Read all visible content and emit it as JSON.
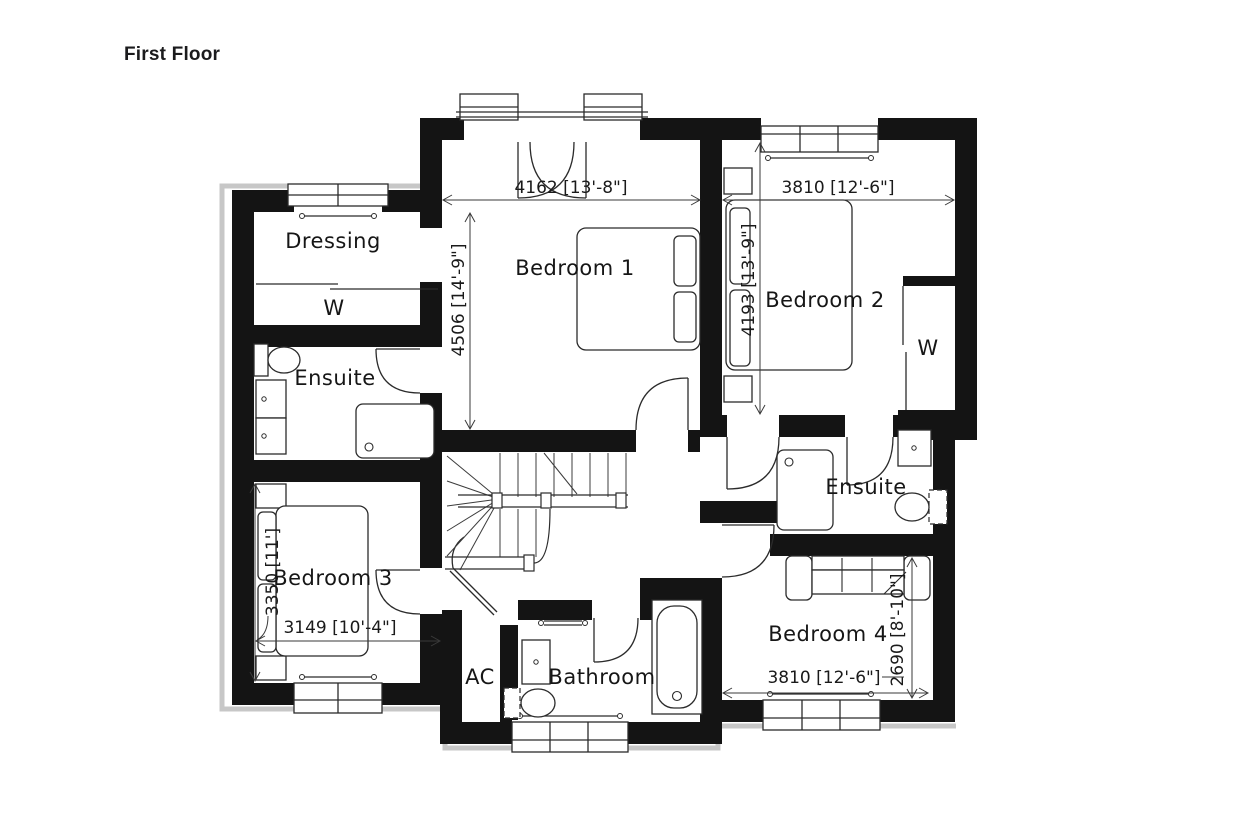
{
  "title": "First Floor",
  "rooms": {
    "dressing": {
      "label": "Dressing",
      "wardrobe": "W"
    },
    "ensuite_left": {
      "label": "Ensuite"
    },
    "bedroom1": {
      "label": "Bedroom 1",
      "width": "4162 [13'-8\"]",
      "depth": "4506 [14'-9\"]"
    },
    "bedroom2": {
      "label": "Bedroom 2",
      "width": "3810 [12'-6\"]",
      "depth": "4193 [13'-9\"]",
      "wardrobe": "W"
    },
    "bedroom3": {
      "label": "Bedroom 3",
      "width": "3149 [10'-4\"]",
      "depth": "3350 [11']"
    },
    "bedroom4": {
      "label": "Bedroom 4",
      "width": "3810 [12'-6\"]",
      "depth": "2690 [8'-10\"]"
    },
    "ensuite_right": {
      "label": "Ensuite"
    },
    "ac": {
      "label": "AC"
    },
    "bathroom": {
      "label": "Bathroom"
    }
  },
  "colors": {
    "walls": "#141414",
    "lines": "#2b2b2b",
    "roof_outline": "#c7c7c7",
    "background": "#ffffff",
    "text": "#161616"
  }
}
